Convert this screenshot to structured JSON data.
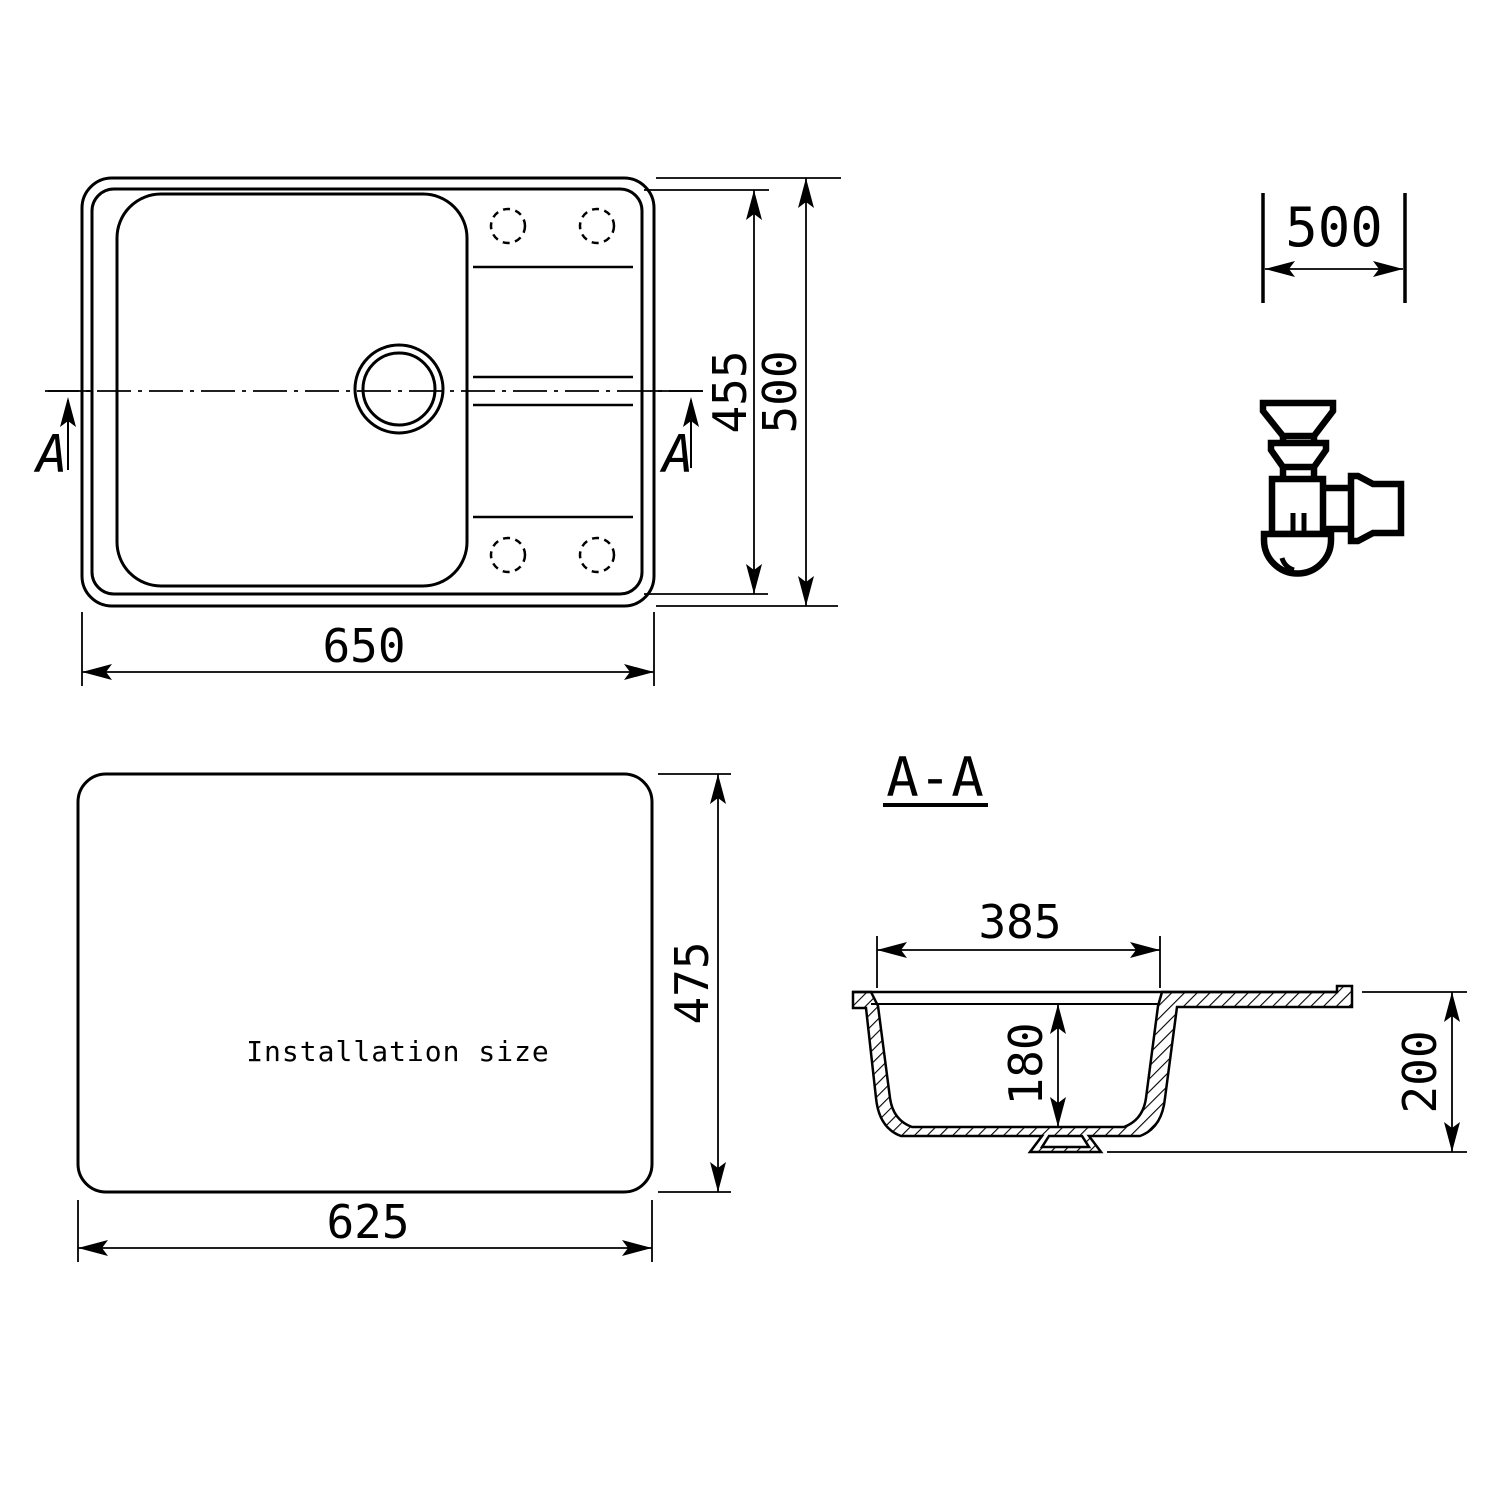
{
  "views": {
    "top": {
      "dim_width": "650",
      "dim_inner_depth": "455",
      "dim_depth": "500",
      "section_marker": "A"
    },
    "cabinet": {
      "dim_width": "500"
    },
    "installation": {
      "label": "Installation size",
      "dim_width": "625",
      "dim_height": "475"
    },
    "section": {
      "title": "A-A",
      "dim_bowl_width": "385",
      "dim_bowl_depth": "180",
      "dim_overall_height": "200"
    }
  },
  "colors": {
    "line": "#000000",
    "background": "#ffffff"
  }
}
